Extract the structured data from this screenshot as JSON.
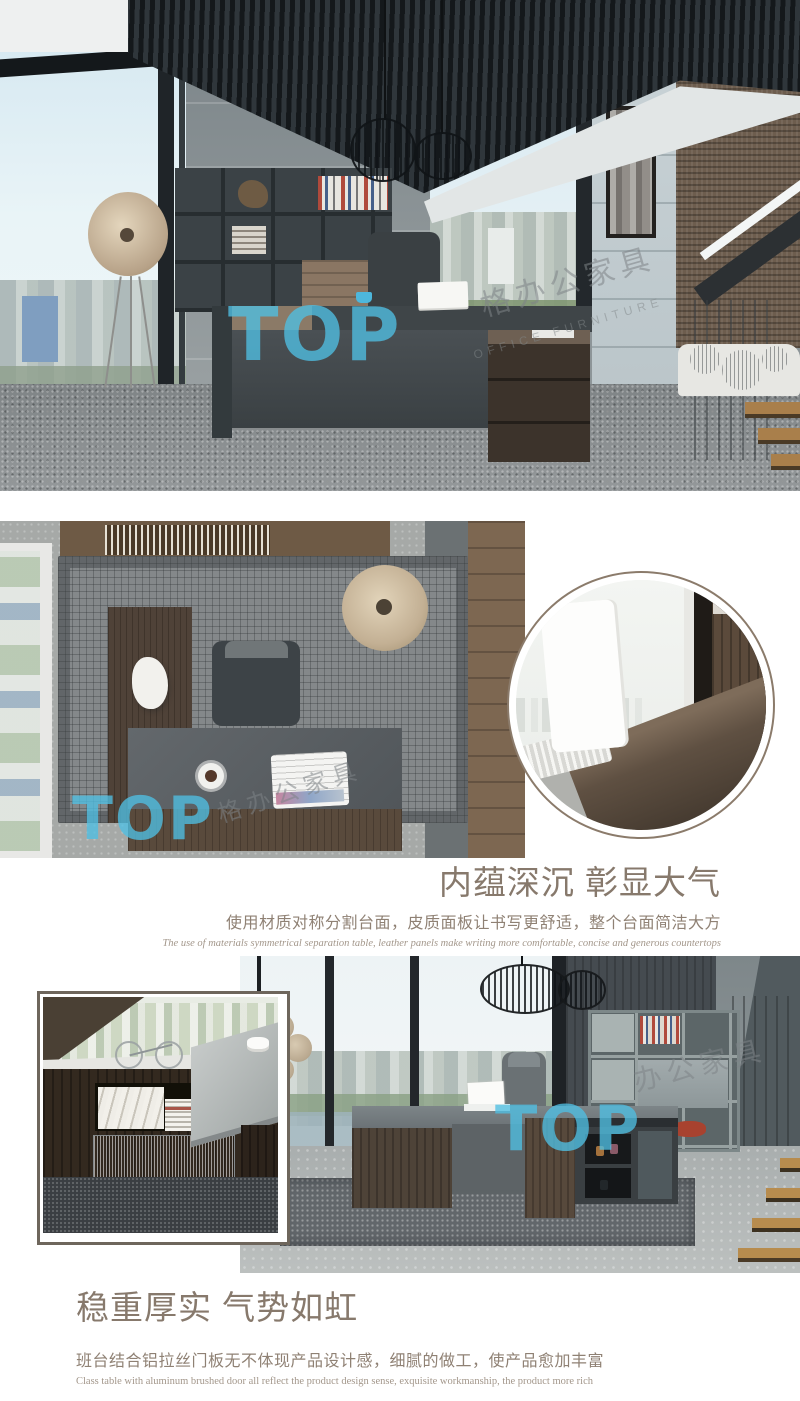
{
  "page": {
    "width": 800,
    "height": 1401,
    "background": "#ffffff"
  },
  "watermark": {
    "brand": "TOP",
    "brand_color": "#4fbfe3",
    "cn_text": "格办公家具",
    "cn_text_short": "办公家具",
    "en_text": "OFFICE FURNITURE"
  },
  "sections": {
    "hero_photo": {
      "alt": "executive-office-room-render"
    },
    "top_view_photo": {
      "alt": "l-shaped-desk-top-view-render"
    },
    "detail_circle_photo": {
      "alt": "laptop-on-desktop-zoom-detail"
    },
    "feature_block_1": {
      "heading": "内蕴深沉 彰显大气",
      "subheading": "使用材质对称分割台面，皮质面板让书写更舒适，整个台面简洁大方",
      "caption_en": "The use of materials symmetrical separation table, leather panels make writing more comfortable, concise and generous countertops",
      "heading_color": "#87796c"
    },
    "bottom_photo": {
      "alt": "executive-desk-office-scene-render"
    },
    "inset_photo": {
      "alt": "aluminum-brushed-door-close-up"
    },
    "feature_block_2": {
      "heading": "稳重厚实 气势如虹",
      "subheading": "班台结合铝拉丝门板无不体现产品设计感，细腻的做工，使产品愈加丰富",
      "caption_en": "Class table with aluminum brushed door all reflect the product design sense, exquisite workmanship, the product more rich",
      "heading_color": "#87796c"
    }
  }
}
